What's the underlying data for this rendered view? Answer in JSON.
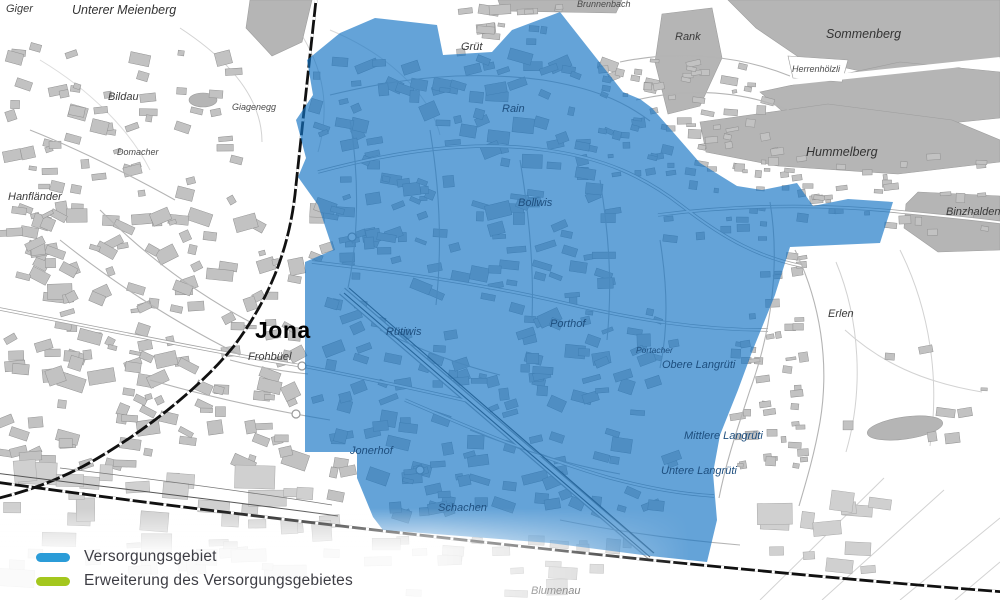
{
  "legend": {
    "items": [
      {
        "id": "versorgungsgebiet",
        "label": "Versorgungsgebiet",
        "color": "#2b9cd8"
      },
      {
        "id": "erweiterung",
        "label": "Erweiterung des Versorgungsgebietes",
        "color": "#a4c71e"
      }
    ]
  },
  "map": {
    "overlay_color": "#1473c4",
    "overlay_opacity": 0.66,
    "labels": [
      {
        "text": "Giger",
        "x": 6,
        "y": 12,
        "cls": "out"
      },
      {
        "text": "Unterer Meienberg",
        "x": 72,
        "y": 14,
        "cls": "out-lg"
      },
      {
        "text": "Bildau",
        "x": 108,
        "y": 100,
        "cls": "out"
      },
      {
        "text": "Giagenegg",
        "x": 232,
        "y": 110,
        "cls": "out-sm"
      },
      {
        "text": "Domacher",
        "x": 117,
        "y": 155,
        "cls": "out-sm"
      },
      {
        "text": "Hanfländer",
        "x": 8,
        "y": 200,
        "cls": "out"
      },
      {
        "text": "Brunnenbach",
        "x": 577,
        "y": 7,
        "cls": "out-sm"
      },
      {
        "text": "Grüt",
        "x": 461,
        "y": 50,
        "cls": "out"
      },
      {
        "text": "Rank",
        "x": 675,
        "y": 40,
        "cls": "out"
      },
      {
        "text": "Sommenberg",
        "x": 826,
        "y": 38,
        "cls": "out-lg"
      },
      {
        "text": "Herrenhölzli",
        "x": 792,
        "y": 72,
        "cls": "out-sm"
      },
      {
        "text": "Hummelberg",
        "x": 806,
        "y": 156,
        "cls": "out-lg"
      },
      {
        "text": "Binzhalden",
        "x": 946,
        "y": 215,
        "cls": "out"
      },
      {
        "text": "Erlen",
        "x": 828,
        "y": 317,
        "cls": "out"
      },
      {
        "text": "Frohbüel",
        "x": 248,
        "y": 360,
        "cls": "out"
      },
      {
        "text": "Blumenau",
        "x": 531,
        "y": 594,
        "cls": "out"
      },
      {
        "text": "Jona",
        "x": 255,
        "y": 338,
        "cls": "city"
      },
      {
        "text": "Rain",
        "x": 502,
        "y": 112,
        "cls": "in"
      },
      {
        "text": "Bollwis",
        "x": 518,
        "y": 206,
        "cls": "in"
      },
      {
        "text": "Rütiwis",
        "x": 386,
        "y": 335,
        "cls": "in"
      },
      {
        "text": "Porthof",
        "x": 550,
        "y": 327,
        "cls": "in"
      },
      {
        "text": "Portacher",
        "x": 636,
        "y": 353,
        "cls": "in-sm"
      },
      {
        "text": "Obere Langrüti",
        "x": 662,
        "y": 368,
        "cls": "in"
      },
      {
        "text": "Mittlere Langrüti",
        "x": 684,
        "y": 439,
        "cls": "in"
      },
      {
        "text": "Untere Langrüti",
        "x": 661,
        "y": 474,
        "cls": "in"
      },
      {
        "text": "Jonerhof",
        "x": 350,
        "y": 454,
        "cls": "in"
      },
      {
        "text": "Schachen",
        "x": 438,
        "y": 511,
        "cls": "in"
      }
    ]
  }
}
